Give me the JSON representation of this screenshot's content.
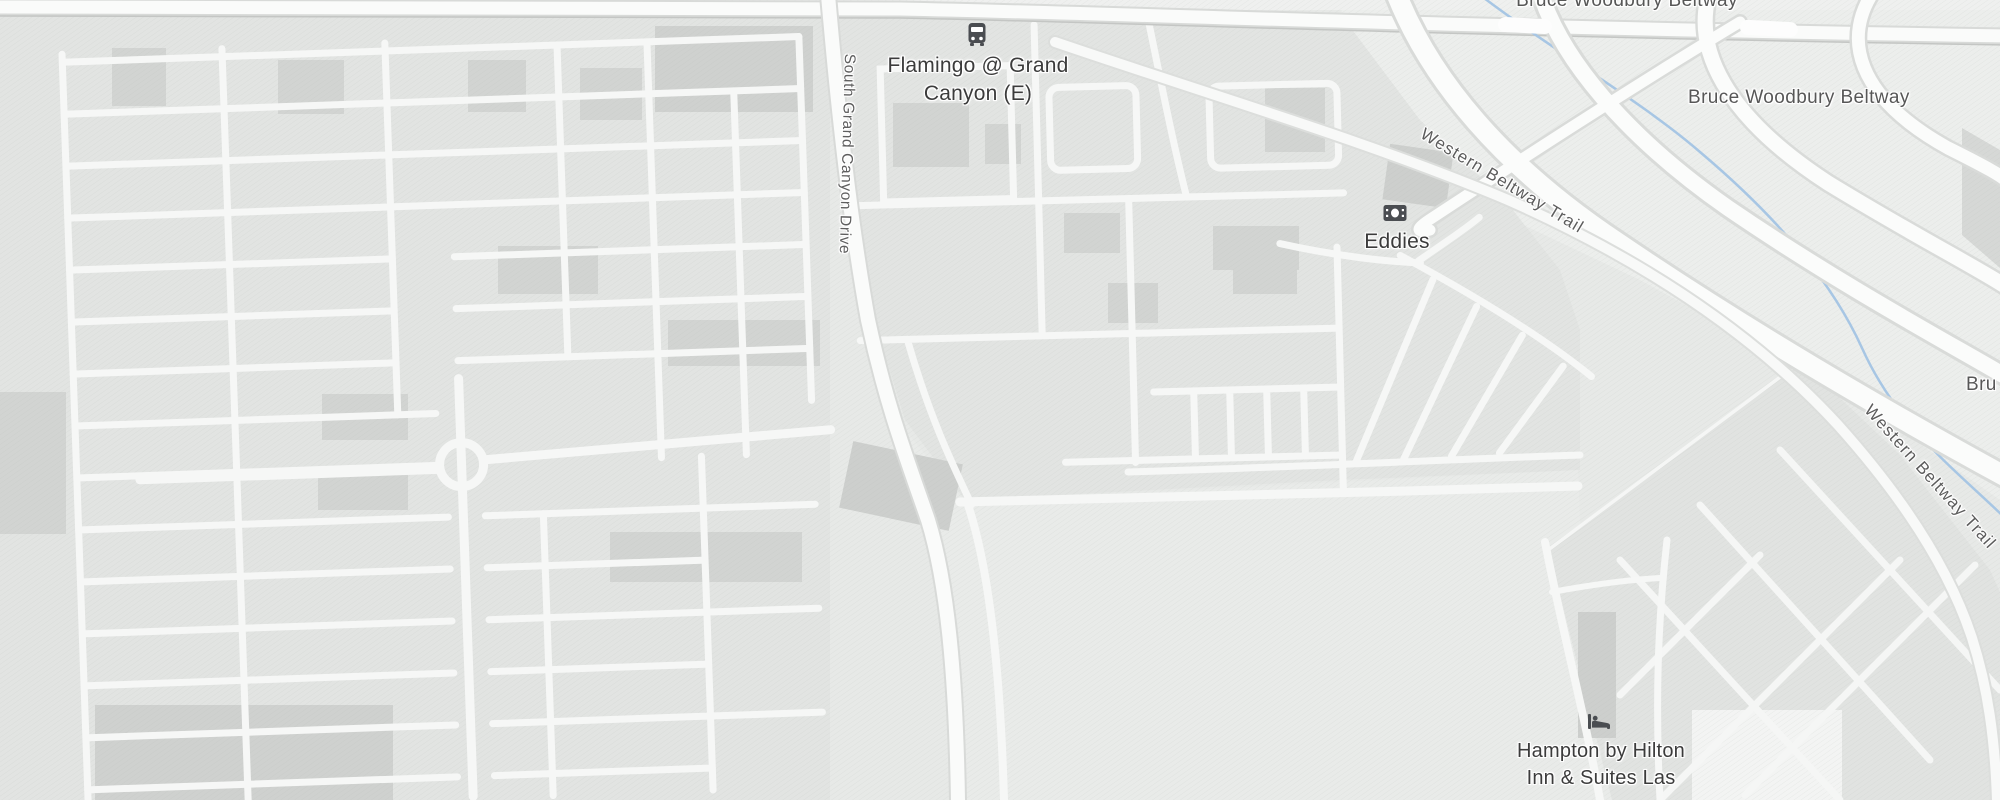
{
  "map": {
    "style": "grayscale-road-map",
    "colors": {
      "land": "#e7e9e7",
      "residential": "#e2e4e2",
      "open_land": "#e9ebe9",
      "highway_zone": "#eceeec",
      "street_fill": "#f7f8f7",
      "road_casing": "#d8dad8",
      "building": "#d2d4d2",
      "water": "#a7c6e4",
      "poi_text": "#3b3b3b",
      "road_text": "#575757",
      "icon_color": "#53565a"
    },
    "pois": {
      "bus_stop": {
        "line1": "Flamingo @ Grand",
        "line2": "Canyon (E)",
        "icon": "bus"
      },
      "eddies": {
        "name": "Eddies",
        "icon": "banknote"
      },
      "hotel": {
        "line1": "Hampton by Hilton",
        "line2": "Inn & Suites Las",
        "icon": "bed"
      }
    },
    "roads": {
      "beltway_top": "Bruce Woodbury Beltway",
      "beltway_mid": "Bruce Woodbury Beltway",
      "beltway_clipped": "Bru",
      "trail_upper": "Western Beltway Trail",
      "trail_lower": "Western Beltway Trail",
      "grand_canyon_drive": "South Grand Canyon Drive"
    }
  }
}
